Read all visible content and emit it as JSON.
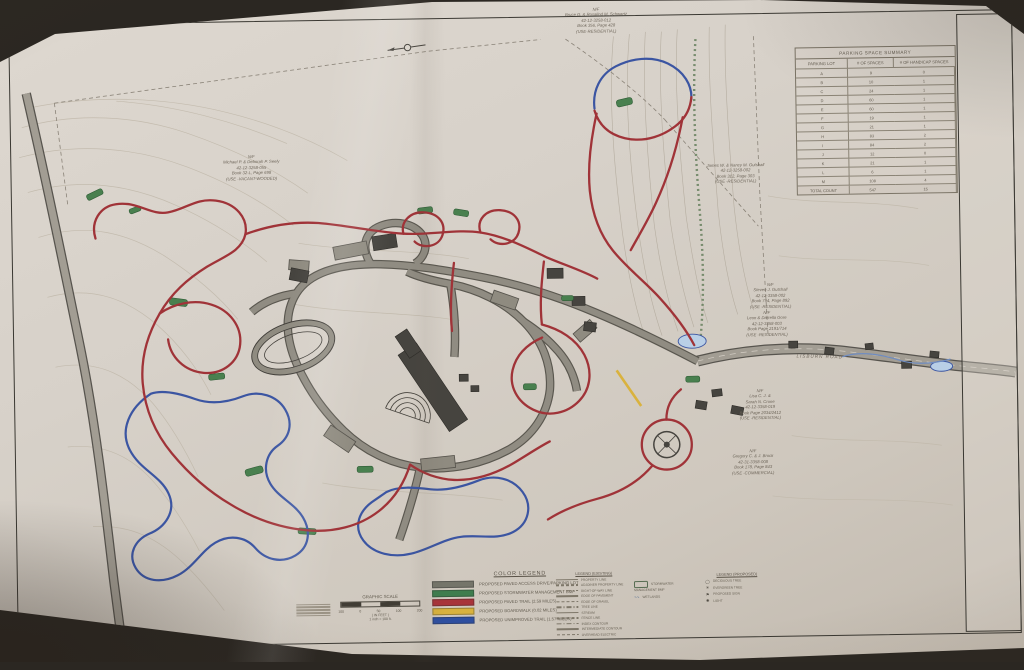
{
  "colors": {
    "paper": "#d7d1c9",
    "red_trail": "#a03338",
    "blue_trail": "#3b55a2",
    "green_bmp": "#49804f",
    "yellow_boardwalk": "#d9b23e",
    "road_gray": "#908c82"
  },
  "parking_table": {
    "title": "PARKING SPACE SUMMARY",
    "columns": [
      "PARKING LOT",
      "# OF SPACES",
      "# OF HANDICAP SPACES"
    ],
    "rows": [
      [
        "A",
        "9",
        "0"
      ],
      [
        "B",
        "10",
        "1"
      ],
      [
        "C",
        "24",
        "1"
      ],
      [
        "D",
        "60",
        "1"
      ],
      [
        "E",
        "60",
        "1"
      ],
      [
        "F",
        "19",
        "1"
      ],
      [
        "G",
        "21",
        "1"
      ],
      [
        "H",
        "83",
        "2"
      ],
      [
        "I",
        "84",
        "2"
      ],
      [
        "J",
        "12",
        "0"
      ],
      [
        "K",
        "21",
        "1"
      ],
      [
        "L",
        "6",
        "1"
      ],
      [
        "M",
        "108",
        "4"
      ]
    ],
    "total": [
      "TOTAL COUNT",
      "547",
      "15"
    ]
  },
  "color_legend": {
    "title": "COLOR LEGEND",
    "items": [
      {
        "color": "#75756a",
        "label": "PROPOSED PAVED ACCESS DRIVE/PARKING LOT"
      },
      {
        "color": "#3e7d4e",
        "label": "PROPOSED STORMWATER MANAGEMENT BMP"
      },
      {
        "color": "#a8343a",
        "label": "PROPOSED PAVED TRAIL (2.59 MILES)"
      },
      {
        "color": "#d8b23e",
        "label": "PROPOSED BOARDWALK (0.02 MILES)"
      },
      {
        "color": "#2e4fa0",
        "label": "PROPOSED UNIMPROVED TRAIL (1.57 MILES)"
      }
    ]
  },
  "graphic_scale": {
    "title": "GRAPHIC SCALE",
    "ticks": [
      "100",
      "0",
      "50",
      "100",
      "200"
    ],
    "unit_note": "( IN FEET )",
    "scale_note": "1 inch = 100 ft."
  },
  "legend_existing": {
    "title": "LEGEND (EXISTING)",
    "items": [
      {
        "label": "PROPERTY LINE"
      },
      {
        "label": "ADJOINER PROPERTY LINE"
      },
      {
        "label": "RIGHT-OF-WAY LINE"
      },
      {
        "label": "EDGE OF PAVEMENT"
      },
      {
        "label": "EDGE OF GRAVEL"
      },
      {
        "label": "TREE LINE"
      },
      {
        "label": "STREAM"
      },
      {
        "label": "FENCE LINE"
      },
      {
        "label": "INDEX CONTOUR"
      },
      {
        "label": "INTERMEDIATE CONTOUR"
      },
      {
        "label": "OVERHEAD ELECTRIC"
      }
    ]
  },
  "legend_mid": {
    "bmp_label": "STORMWATER MANAGEMENT BMP",
    "wetlands_label": "WETLANDS",
    "wetlands_glyph": "∿∿"
  },
  "legend_proposed": {
    "title": "LEGEND (PROPOSED)",
    "items": [
      {
        "glyph": "◯",
        "label": "DECIDUOUS TREE"
      },
      {
        "glyph": "✳",
        "label": "EVERGREEN TREE"
      },
      {
        "glyph": "⚑",
        "label": "PROPOSED SIGN"
      },
      {
        "glyph": "✺",
        "label": "LIGHT"
      }
    ]
  },
  "title_block": {
    "township": "UPPER ALLEN TOWNSHIP",
    "project": "GENERATIONS PARK (1140 LISBURN ROAD) MASTER PLAN",
    "sheet_title": "GENERATION PARK MASTER PLAN",
    "firm": "C.S. DAVIDSON, INC.",
    "revisions": {
      "columns": [
        "NO.",
        "DATE",
        "DESCRIPTION"
      ]
    },
    "fields": [
      {
        "label": "DESIGNED BY",
        "value": "CJK"
      },
      {
        "label": "CHECKED BY",
        "value": ""
      },
      {
        "label": "SCALE",
        "value": "1\"=100'"
      },
      {
        "label": "DATE",
        "value": ""
      },
      {
        "label": "DRAWING NO.",
        "value": ""
      },
      {
        "label": "FILE NO.",
        "value": ""
      }
    ],
    "sheet_label": "SHEET NO.",
    "sheet_number": "1 OF 1"
  },
  "parcels": [
    {
      "text": "N/F\nBruce G. & Rosalind M. Schwartz\n42-12-3258-012\nBook 356, Page 428\n(USE-RESIDENTIAL)"
    },
    {
      "text": "N/F\nMichael P. & Deborah P. Seely\n42-12-3258-055\nBook 32-L, Page 698\n(USE -VACANT-WOODED)"
    },
    {
      "text": "James W. & Nancy M. Gutshall\n42-12-3258-002\nBook 312, Page 303\n(USE -RESIDENTIAL)"
    },
    {
      "text": "N/F\nSteven J. Gutshall\n42-12-3358-002\nBook 794, Page 892\n(USE -RESIDENTIAL)"
    },
    {
      "text": "N/F\nLeon & Darrella Gore\n42-12-3358-003\nBook Page 2191/714\n(USE -RESIDENTIAL)"
    },
    {
      "text": "N/F\nLisa C. J. &\nSarah N. Crone\n42-12-3358-019\nBook Page 2034/2412\n(USE -RESIDENTIAL)"
    },
    {
      "text": "N/F\nGregory C. & J. Brock\n42-31-3358-008\nBook 178, Page 843\n(USE -COMMERCIAL)"
    }
  ],
  "map": {
    "road_label": "LISBURN ROAD"
  }
}
